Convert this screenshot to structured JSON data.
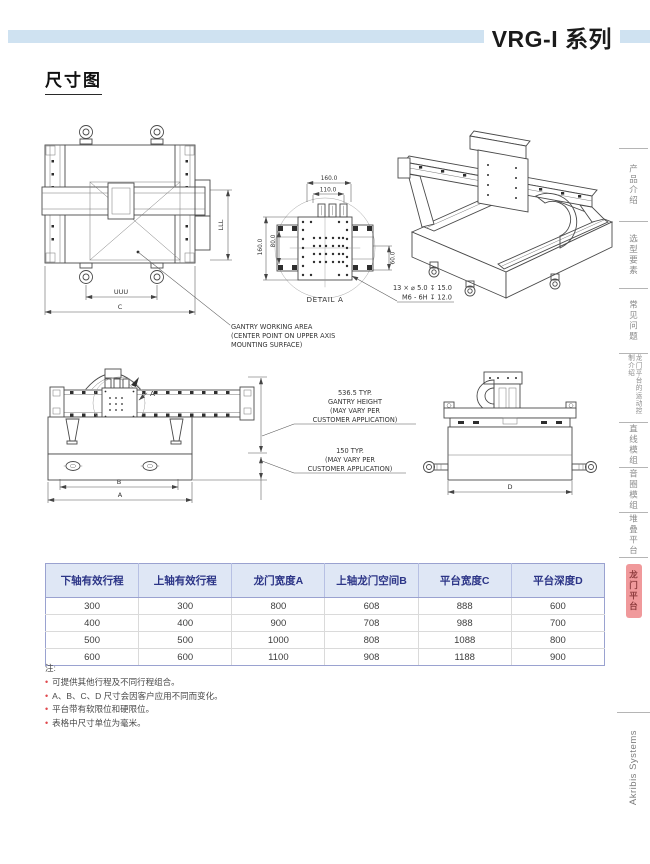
{
  "page": {
    "title": "VRG-I 系列",
    "section_heading": "尺寸图",
    "brand_vertical": "Akribis Systems"
  },
  "sidebar": {
    "tabs": [
      {
        "label": "产品介绍",
        "active": false
      },
      {
        "label": "选型要素",
        "active": false
      },
      {
        "label": "常见问题",
        "active": false
      },
      {
        "label": "龙门平台的运动控制介绍",
        "active": false
      },
      {
        "label": "直线模组",
        "active": false
      },
      {
        "label": "音圈模组",
        "active": false
      },
      {
        "label": "堆叠平台",
        "active": false
      },
      {
        "label": "龙门平台",
        "active": true
      }
    ]
  },
  "drawings": {
    "top_view": {
      "dim_inner": "UUU",
      "dim_outer": "C",
      "dim_side": "LLL"
    },
    "detail_a": {
      "label": "DETAIL A",
      "dim_top_outer": "160.0",
      "dim_top_inner": "110.0",
      "dim_left_outer": "160.0",
      "dim_left_inner": "80.0",
      "dim_right": "60.0",
      "callout_line1": "13 × ⌀ 5.0  ↧ 15.0",
      "callout_line2": "M6 - 6H  ↧ 12.0"
    },
    "working_area_note": [
      "GANTRY WORKING AREA",
      "(CENTER POINT ON UPPER AXIS",
      "MOUNTING SURFACE)"
    ],
    "front_view": {
      "dim_inner": "B",
      "dim_outer": "A",
      "detail_flag": "A"
    },
    "side_view": {
      "dim": "D"
    },
    "gantry_height_note": [
      "536.5 TYP.",
      "GANTRY HEIGHT",
      "(MAY VARY PER",
      "CUSTOMER APPLICATION)"
    ],
    "base_height_note": [
      "150 TYP.",
      "(MAY VARY PER",
      "CUSTOMER APPLICATION)"
    ]
  },
  "table": {
    "headers": [
      "下轴有效行程",
      "上轴有效行程",
      "龙门宽度A",
      "上轴龙门空间B",
      "平台宽度C",
      "平台深度D"
    ],
    "rows": [
      [
        "300",
        "300",
        "800",
        "608",
        "888",
        "600"
      ],
      [
        "400",
        "400",
        "900",
        "708",
        "988",
        "700"
      ],
      [
        "500",
        "500",
        "1000",
        "808",
        "1088",
        "800"
      ],
      [
        "600",
        "600",
        "1100",
        "908",
        "1188",
        "900"
      ]
    ]
  },
  "notes": {
    "label": "注:",
    "items": [
      "可提供其他行程及不同行程组合。",
      "A、B、C、D 尺寸会因客户应用不同而变化。",
      "平台带有软限位和硬限位。",
      "表格中尺寸单位为毫米。"
    ]
  },
  "colors": {
    "header_bar": "#cfe2f1",
    "table_header_bg": "#dfe7f5",
    "table_header_text": "#2c3587",
    "note_bullet": "#e0484d",
    "active_tab_bg": "#f0999b"
  }
}
